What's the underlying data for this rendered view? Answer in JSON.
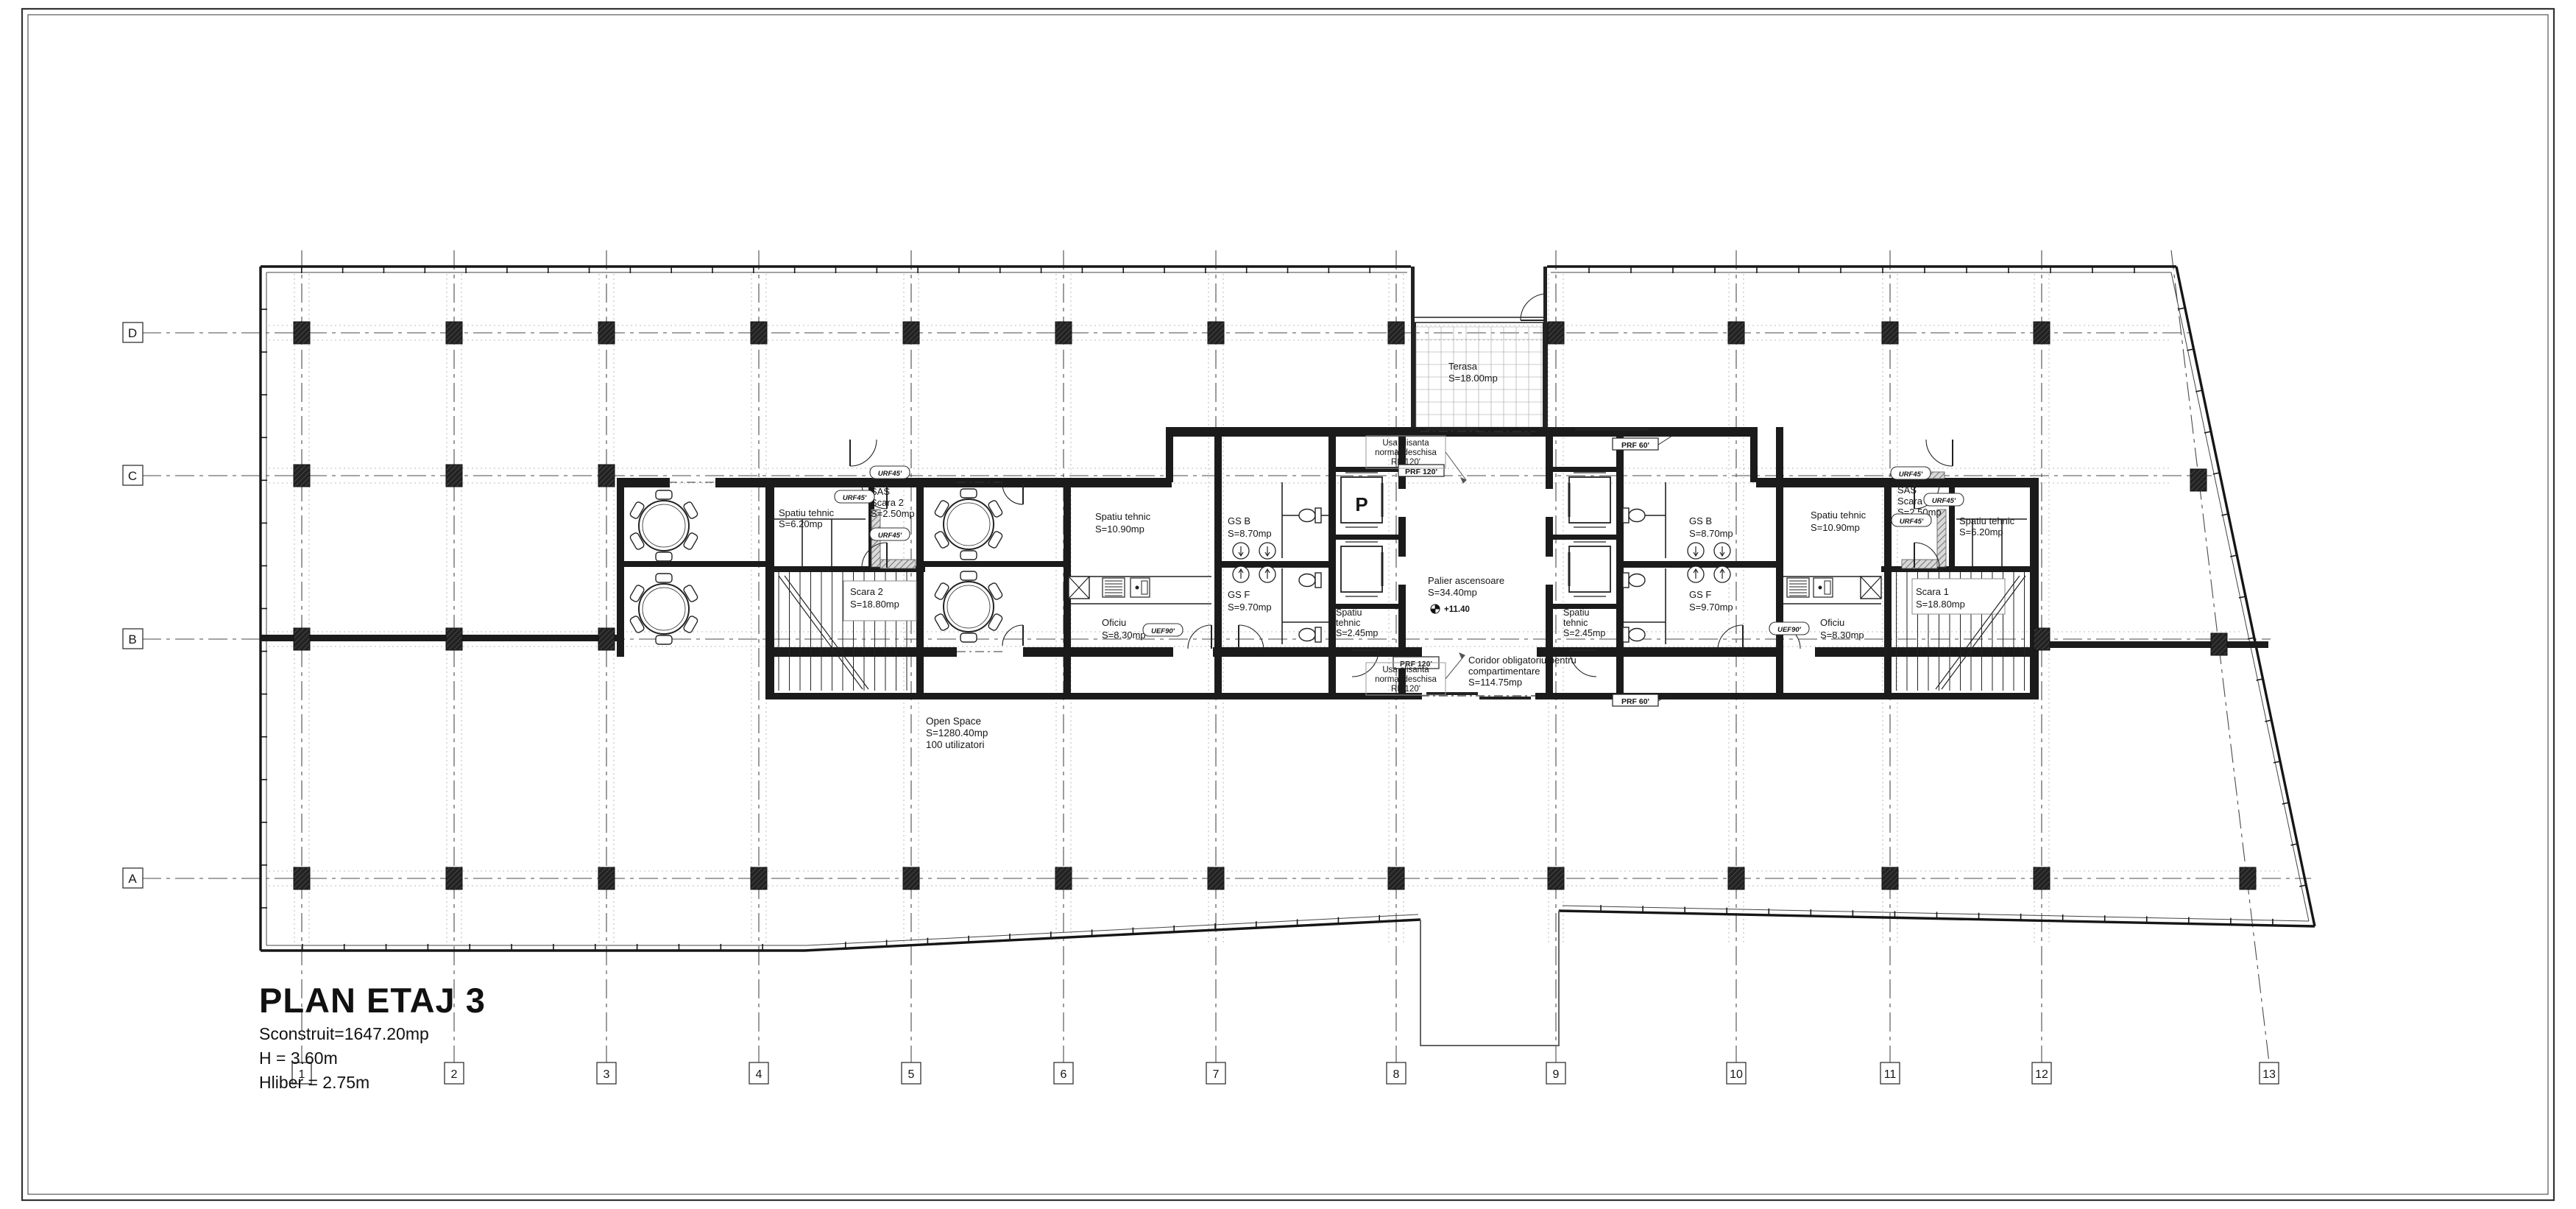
{
  "page": {
    "title": "PLAN ETAJ 3",
    "built_area": "Sconstruit=1647.20mp",
    "height": "H = 3.60m",
    "clear_height": "Hliber = 2.75m"
  },
  "grid": {
    "row_labels": [
      "D",
      "C",
      "B",
      "A"
    ],
    "column_labels": [
      "1",
      "2",
      "3",
      "4",
      "5",
      "6",
      "7",
      "8",
      "9",
      "10",
      "11",
      "12",
      "13"
    ]
  },
  "labels": {
    "open_space": [
      "Open Space",
      "S=1280.40mp",
      "100 utilizatori"
    ],
    "terasa": [
      "Terasa",
      "S=18.00mp"
    ],
    "palier": [
      "Palier ascensoare",
      "S=34.40mp"
    ],
    "coridor": [
      "Coridor obligatoriu pentru",
      "compartimentare",
      "S=114.75mp"
    ],
    "st620_l": [
      "Spatiu tehnic",
      "S=6.20mp"
    ],
    "st620_r": [
      "Spatiu tehnic",
      "S=6.20mp"
    ],
    "sas2": [
      "SAS",
      "Scara 2",
      "S=2.50mp"
    ],
    "sas1": [
      "SAS",
      "Scara 1",
      "S=2.50mp"
    ],
    "scara2": [
      "Scara 2",
      "S=18.80mp"
    ],
    "scara1": [
      "Scara 1",
      "S=18.80mp"
    ],
    "st1090_l": [
      "Spatiu tehnic",
      "S=10.90mp"
    ],
    "st1090_r": [
      "Spatiu tehnic",
      "S=10.90mp"
    ],
    "oficiu_l": [
      "Oficiu",
      "S=8.30mp"
    ],
    "oficiu_r": [
      "Oficiu",
      "S=8.30mp"
    ],
    "gsb_l": [
      "GS B",
      "S=8.70mp"
    ],
    "gsb_r": [
      "GS B",
      "S=8.70mp"
    ],
    "gsf_l": [
      "GS F",
      "S=9.70mp"
    ],
    "gsf_r": [
      "GS F",
      "S=9.70mp"
    ],
    "st245_l": [
      "Spatiu",
      "tehnic",
      "S=2.45mp"
    ],
    "st245_r": [
      "Spatiu",
      "tehnic",
      "S=2.45mp"
    ],
    "sliding_note": [
      "Usa glisanta",
      "normal deschisa",
      "RF 120'"
    ],
    "elevator_p": "P",
    "level_marker": "+11.40",
    "tag_urf45": "URF45'",
    "tag_uef90": "UEF90'",
    "tag_prf120": "PRF 120'",
    "tag_prf60": "PRF 60'"
  },
  "colors": {
    "wall": "#1b1b1b",
    "line": "#222222",
    "grid": "#4a4a4a",
    "light": "#a8a8a8",
    "note": "#8d8d8d",
    "bg": "#ffffff"
  }
}
